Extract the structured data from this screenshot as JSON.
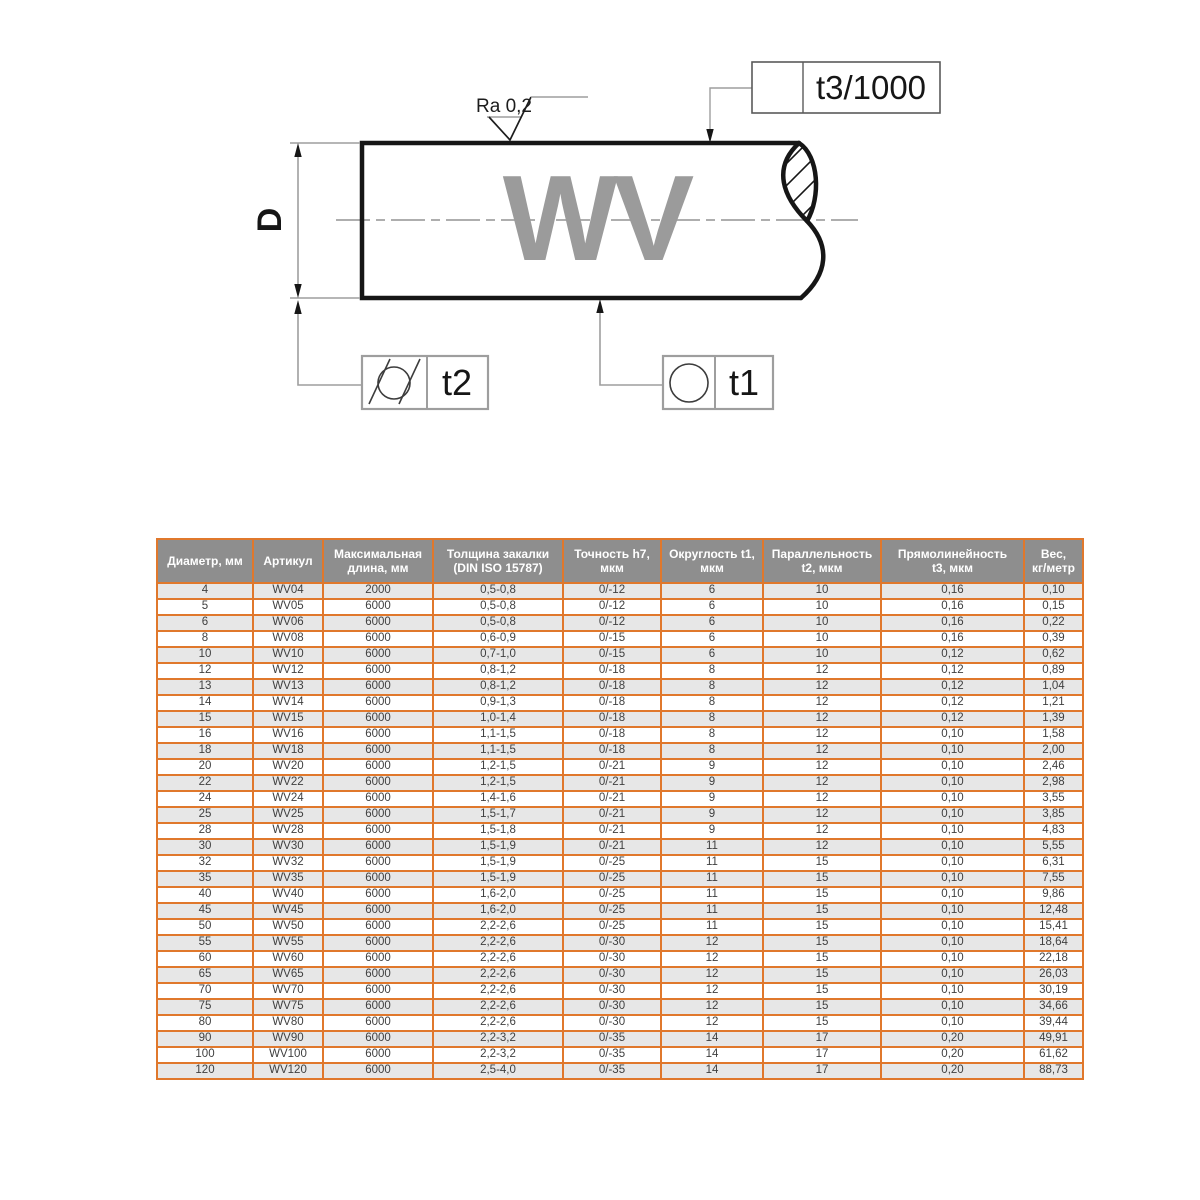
{
  "diagram": {
    "labels": {
      "shaft_marking": "WV",
      "diameter": "D",
      "roughness": "Ra 0,2",
      "straightness_tolerance": "t3/1000",
      "cylindricity_tolerance": "t2",
      "roundness_tolerance": "t1"
    },
    "colors": {
      "outline": "#161616",
      "auxiliary": "#9e9e9e",
      "marking_text": "#9b9b9b"
    }
  },
  "table": {
    "headers": [
      "Диаметр, мм",
      "Артикул",
      "Максимальная\nдлина, мм",
      "Толщина закалки\n(DIN ISO 15787)",
      "Точность h7,\nмкм",
      "Округлость t1,\nмкм",
      "Параллельность\nt2, мкм",
      "Прямолинейность\nt3, мкм",
      "Вес,\nкг/метр"
    ],
    "rows": [
      [
        "4",
        "WV04",
        "2000",
        "0,5-0,8",
        "0/-12",
        "6",
        "10",
        "0,16",
        "0,10"
      ],
      [
        "5",
        "WV05",
        "6000",
        "0,5-0,8",
        "0/-12",
        "6",
        "10",
        "0,16",
        "0,15"
      ],
      [
        "6",
        "WV06",
        "6000",
        "0,5-0,8",
        "0/-12",
        "6",
        "10",
        "0,16",
        "0,22"
      ],
      [
        "8",
        "WV08",
        "6000",
        "0,6-0,9",
        "0/-15",
        "6",
        "10",
        "0,16",
        "0,39"
      ],
      [
        "10",
        "WV10",
        "6000",
        "0,7-1,0",
        "0/-15",
        "6",
        "10",
        "0,12",
        "0,62"
      ],
      [
        "12",
        "WV12",
        "6000",
        "0,8-1,2",
        "0/-18",
        "8",
        "12",
        "0,12",
        "0,89"
      ],
      [
        "13",
        "WV13",
        "6000",
        "0,8-1,2",
        "0/-18",
        "8",
        "12",
        "0,12",
        "1,04"
      ],
      [
        "14",
        "WV14",
        "6000",
        "0,9-1,3",
        "0/-18",
        "8",
        "12",
        "0,12",
        "1,21"
      ],
      [
        "15",
        "WV15",
        "6000",
        "1,0-1,4",
        "0/-18",
        "8",
        "12",
        "0,12",
        "1,39"
      ],
      [
        "16",
        "WV16",
        "6000",
        "1,1-1,5",
        "0/-18",
        "8",
        "12",
        "0,10",
        "1,58"
      ],
      [
        "18",
        "WV18",
        "6000",
        "1,1-1,5",
        "0/-18",
        "8",
        "12",
        "0,10",
        "2,00"
      ],
      [
        "20",
        "WV20",
        "6000",
        "1,2-1,5",
        "0/-21",
        "9",
        "12",
        "0,10",
        "2,46"
      ],
      [
        "22",
        "WV22",
        "6000",
        "1,2-1,5",
        "0/-21",
        "9",
        "12",
        "0,10",
        "2,98"
      ],
      [
        "24",
        "WV24",
        "6000",
        "1,4-1,6",
        "0/-21",
        "9",
        "12",
        "0,10",
        "3,55"
      ],
      [
        "25",
        "WV25",
        "6000",
        "1,5-1,7",
        "0/-21",
        "9",
        "12",
        "0,10",
        "3,85"
      ],
      [
        "28",
        "WV28",
        "6000",
        "1,5-1,8",
        "0/-21",
        "9",
        "12",
        "0,10",
        "4,83"
      ],
      [
        "30",
        "WV30",
        "6000",
        "1,5-1,9",
        "0/-21",
        "11",
        "12",
        "0,10",
        "5,55"
      ],
      [
        "32",
        "WV32",
        "6000",
        "1,5-1,9",
        "0/-25",
        "11",
        "15",
        "0,10",
        "6,31"
      ],
      [
        "35",
        "WV35",
        "6000",
        "1,5-1,9",
        "0/-25",
        "11",
        "15",
        "0,10",
        "7,55"
      ],
      [
        "40",
        "WV40",
        "6000",
        "1,6-2,0",
        "0/-25",
        "11",
        "15",
        "0,10",
        "9,86"
      ],
      [
        "45",
        "WV45",
        "6000",
        "1,6-2,0",
        "0/-25",
        "11",
        "15",
        "0,10",
        "12,48"
      ],
      [
        "50",
        "WV50",
        "6000",
        "2,2-2,6",
        "0/-25",
        "11",
        "15",
        "0,10",
        "15,41"
      ],
      [
        "55",
        "WV55",
        "6000",
        "2,2-2,6",
        "0/-30",
        "12",
        "15",
        "0,10",
        "18,64"
      ],
      [
        "60",
        "WV60",
        "6000",
        "2,2-2,6",
        "0/-30",
        "12",
        "15",
        "0,10",
        "22,18"
      ],
      [
        "65",
        "WV65",
        "6000",
        "2,2-2,6",
        "0/-30",
        "12",
        "15",
        "0,10",
        "26,03"
      ],
      [
        "70",
        "WV70",
        "6000",
        "2,2-2,6",
        "0/-30",
        "12",
        "15",
        "0,10",
        "30,19"
      ],
      [
        "75",
        "WV75",
        "6000",
        "2,2-2,6",
        "0/-30",
        "12",
        "15",
        "0,10",
        "34,66"
      ],
      [
        "80",
        "WV80",
        "6000",
        "2,2-2,6",
        "0/-30",
        "12",
        "15",
        "0,10",
        "39,44"
      ],
      [
        "90",
        "WV90",
        "6000",
        "2,2-3,2",
        "0/-35",
        "14",
        "17",
        "0,20",
        "49,91"
      ],
      [
        "100",
        "WV100",
        "6000",
        "2,2-3,2",
        "0/-35",
        "14",
        "17",
        "0,20",
        "61,62"
      ],
      [
        "120",
        "WV120",
        "6000",
        "2,5-4,0",
        "0/-35",
        "14",
        "17",
        "0,20",
        "88,73"
      ]
    ],
    "colors": {
      "border": "#e0782c",
      "header_bg": "#8e8e8e",
      "header_text": "#ffffff",
      "row_alt": "#e7e7e7",
      "row": "#ffffff",
      "text": "#3f3f3f"
    }
  }
}
